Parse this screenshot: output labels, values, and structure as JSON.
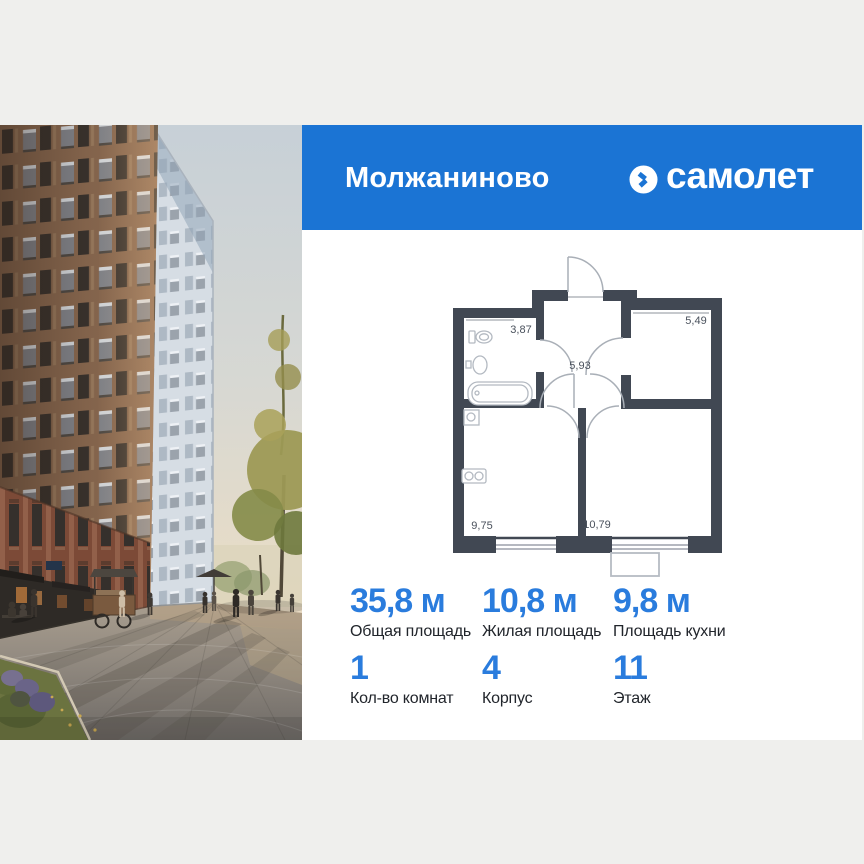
{
  "header": {
    "project_title": "Молжаниново",
    "brand_name": "самолет",
    "band_color": "#1b74d4"
  },
  "floor_plan": {
    "wall_color": "#414853",
    "rooms": [
      {
        "name": "bathroom",
        "area": "3,87"
      },
      {
        "name": "hallway",
        "area": "5,93"
      },
      {
        "name": "room",
        "area": "5,49"
      },
      {
        "name": "kitchen",
        "area": "9,75"
      },
      {
        "name": "living-room",
        "area": "10,79"
      }
    ]
  },
  "stats": {
    "accent_color": "#2a7cdd",
    "row1": [
      {
        "value": "35,8 м",
        "label": "Общая площадь"
      },
      {
        "value": "10,8 м",
        "label": "Жилая площадь"
      },
      {
        "value": "9,8 м",
        "label": "Площадь кухни"
      }
    ],
    "row2": [
      {
        "value": "1",
        "label": "Кол-во комнат"
      },
      {
        "value": "4",
        "label": "Корпус"
      },
      {
        "value": "11",
        "label": "Этаж"
      }
    ]
  }
}
